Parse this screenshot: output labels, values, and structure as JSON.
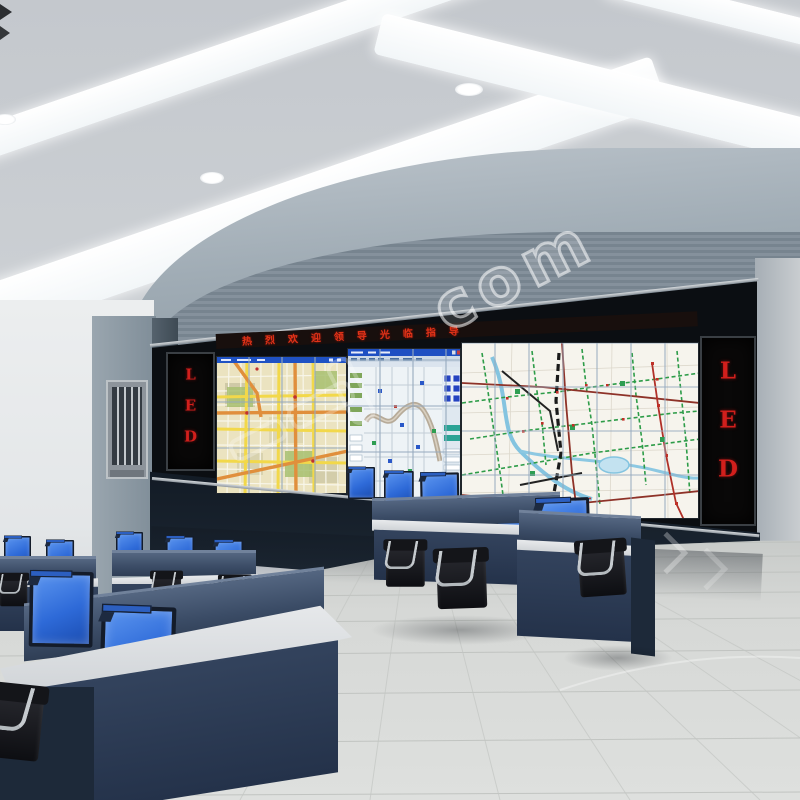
{
  "scene": {
    "description": "3D render of a traffic control command center with curved video wall, operator desks and blue monitors"
  },
  "video_wall": {
    "ticker_text": "热烈欢迎领导光临指导",
    "ticker_color": "#e03318",
    "led_panel_left": {
      "label": "LED",
      "color": "#d11f1c"
    },
    "led_panel_right": {
      "label": "LED",
      "color": "#d11f1c"
    },
    "screens": [
      {
        "name": "city-street-map"
      },
      {
        "name": "gis-monitoring-application"
      },
      {
        "name": "transit-route-map"
      }
    ]
  },
  "watermark": {
    "text": "com"
  },
  "palette": {
    "monitor_blue": "#2e6ad8",
    "desk_navy": "#2c3a52",
    "led_red": "#d11f1c",
    "ceiling_gray": "#c8ccd1",
    "soffit_gray": "#8b98a2",
    "floor_gray": "#d6d8d6",
    "map_cream": "#f6f4ed",
    "map_yellow": "#f2d84a"
  }
}
